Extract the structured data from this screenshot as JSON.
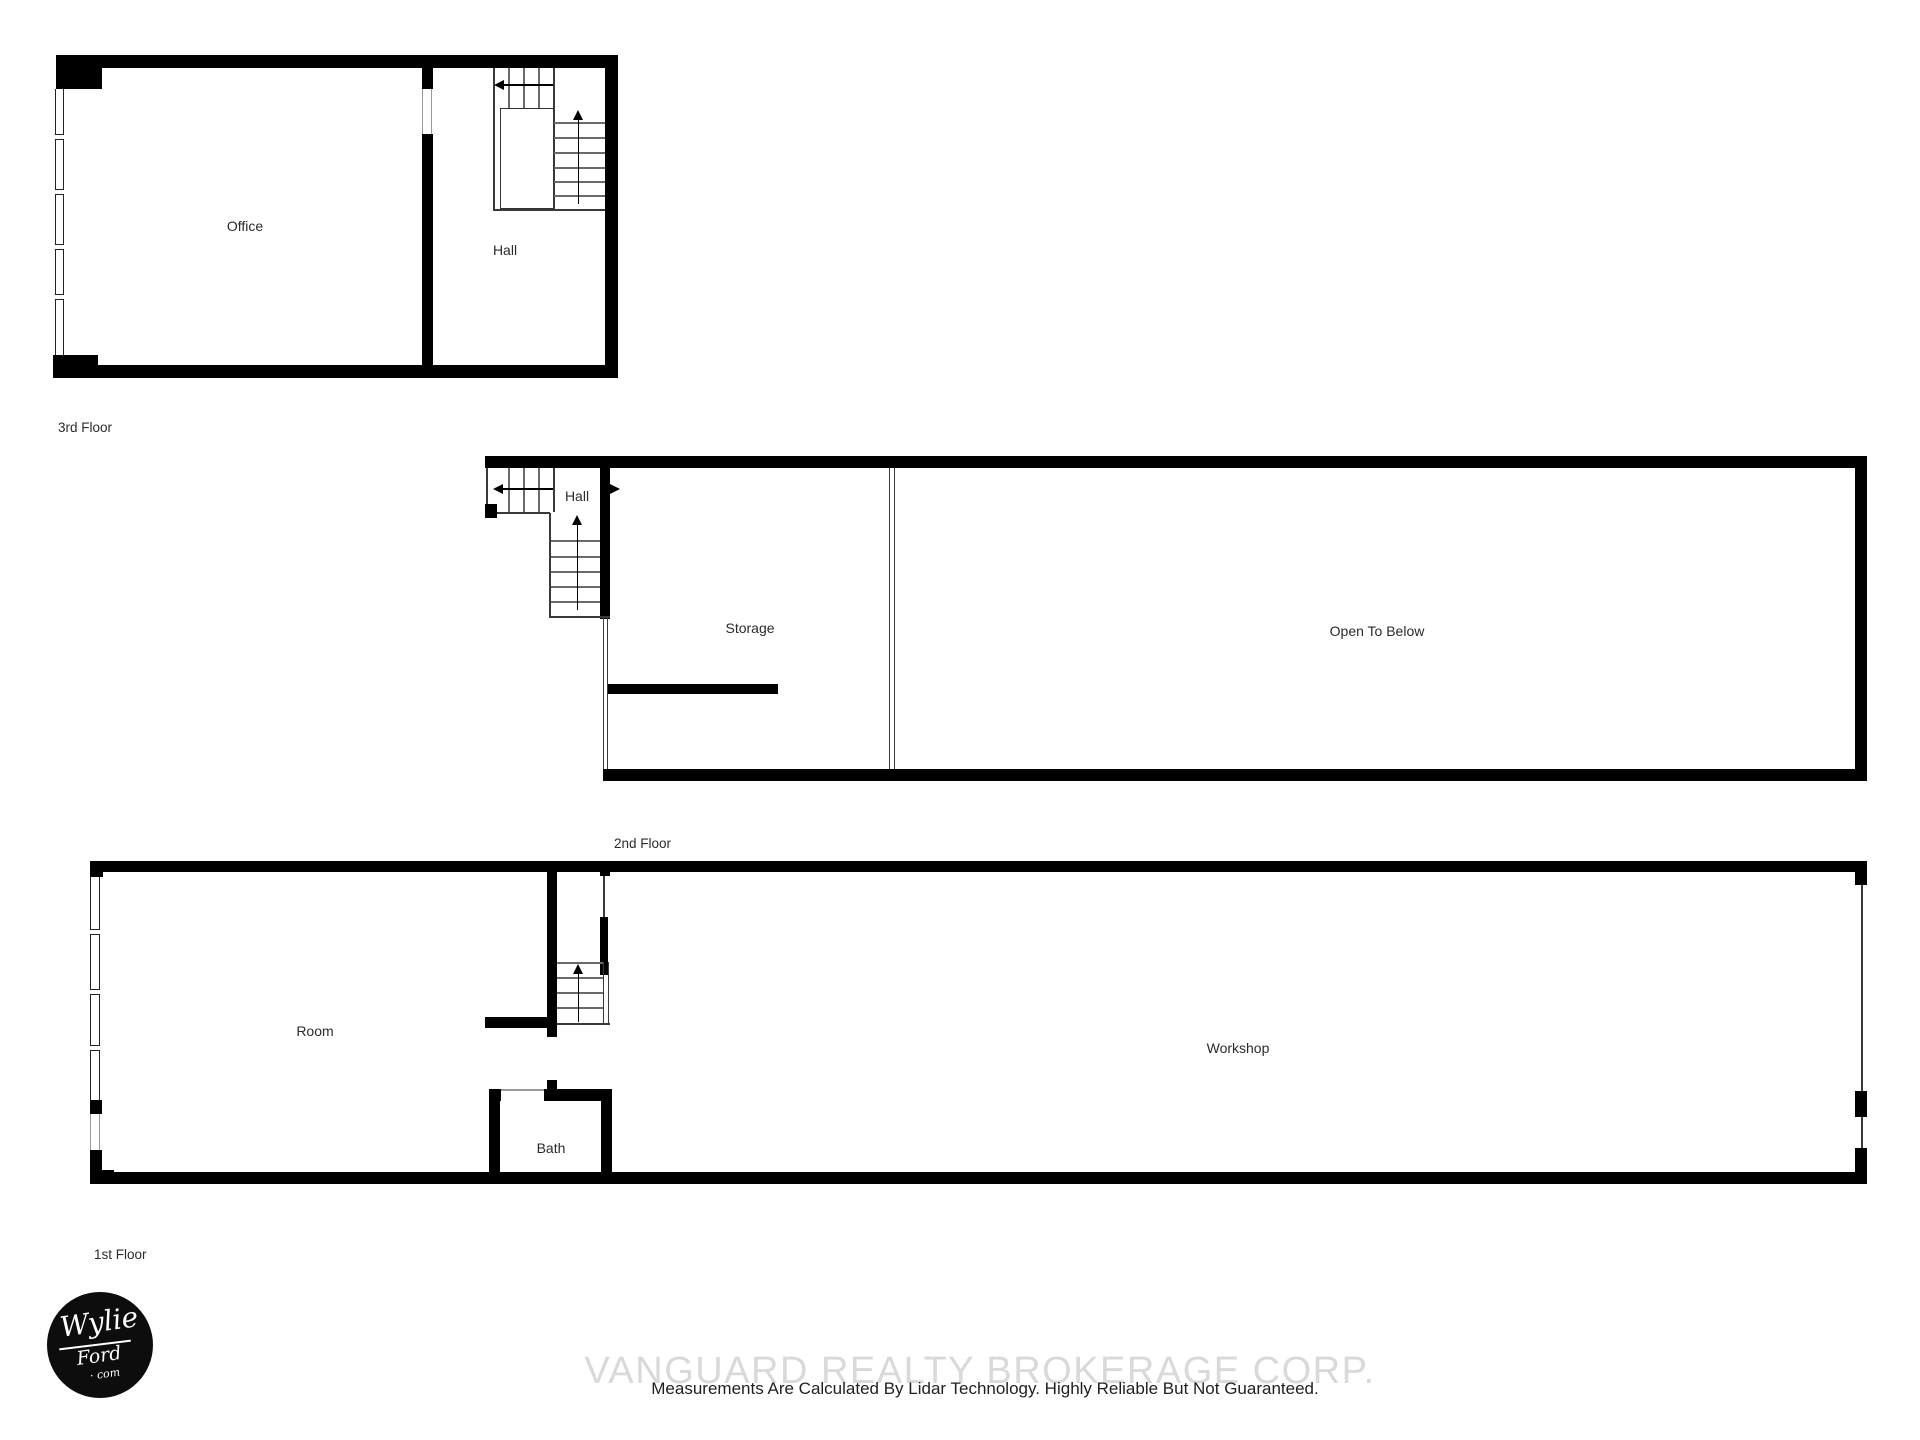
{
  "page": {
    "background": "#ffffff"
  },
  "floors": [
    {
      "caption": "3rd Floor",
      "rooms": {
        "office": "Office",
        "hall": "Hall"
      }
    },
    {
      "caption": "2nd Floor",
      "rooms": {
        "hall": "Hall",
        "storage": "Storage",
        "open_to_below": "Open To Below"
      }
    },
    {
      "caption": "1st Floor",
      "rooms": {
        "room": "Room",
        "workshop": "Workshop",
        "bath": "Bath"
      }
    }
  ],
  "logo": {
    "line1": "Wylie",
    "line2": "Ford",
    "line3": "· com"
  },
  "watermark": {
    "text": "VANGUARD REALTY BROKERAGE CORP.",
    "color": "#d9d9d9"
  },
  "disclaimer": {
    "text": "Measurements Are Calculated By Lidar Technology. Highly Reliable But Not Guaranteed.",
    "color": "#1f1f1f"
  },
  "colors": {
    "wall": "#000000",
    "thin_line": "#3a3a3a",
    "stair_tread": "#6a6a6a",
    "label_text": "#2b2b2b"
  }
}
